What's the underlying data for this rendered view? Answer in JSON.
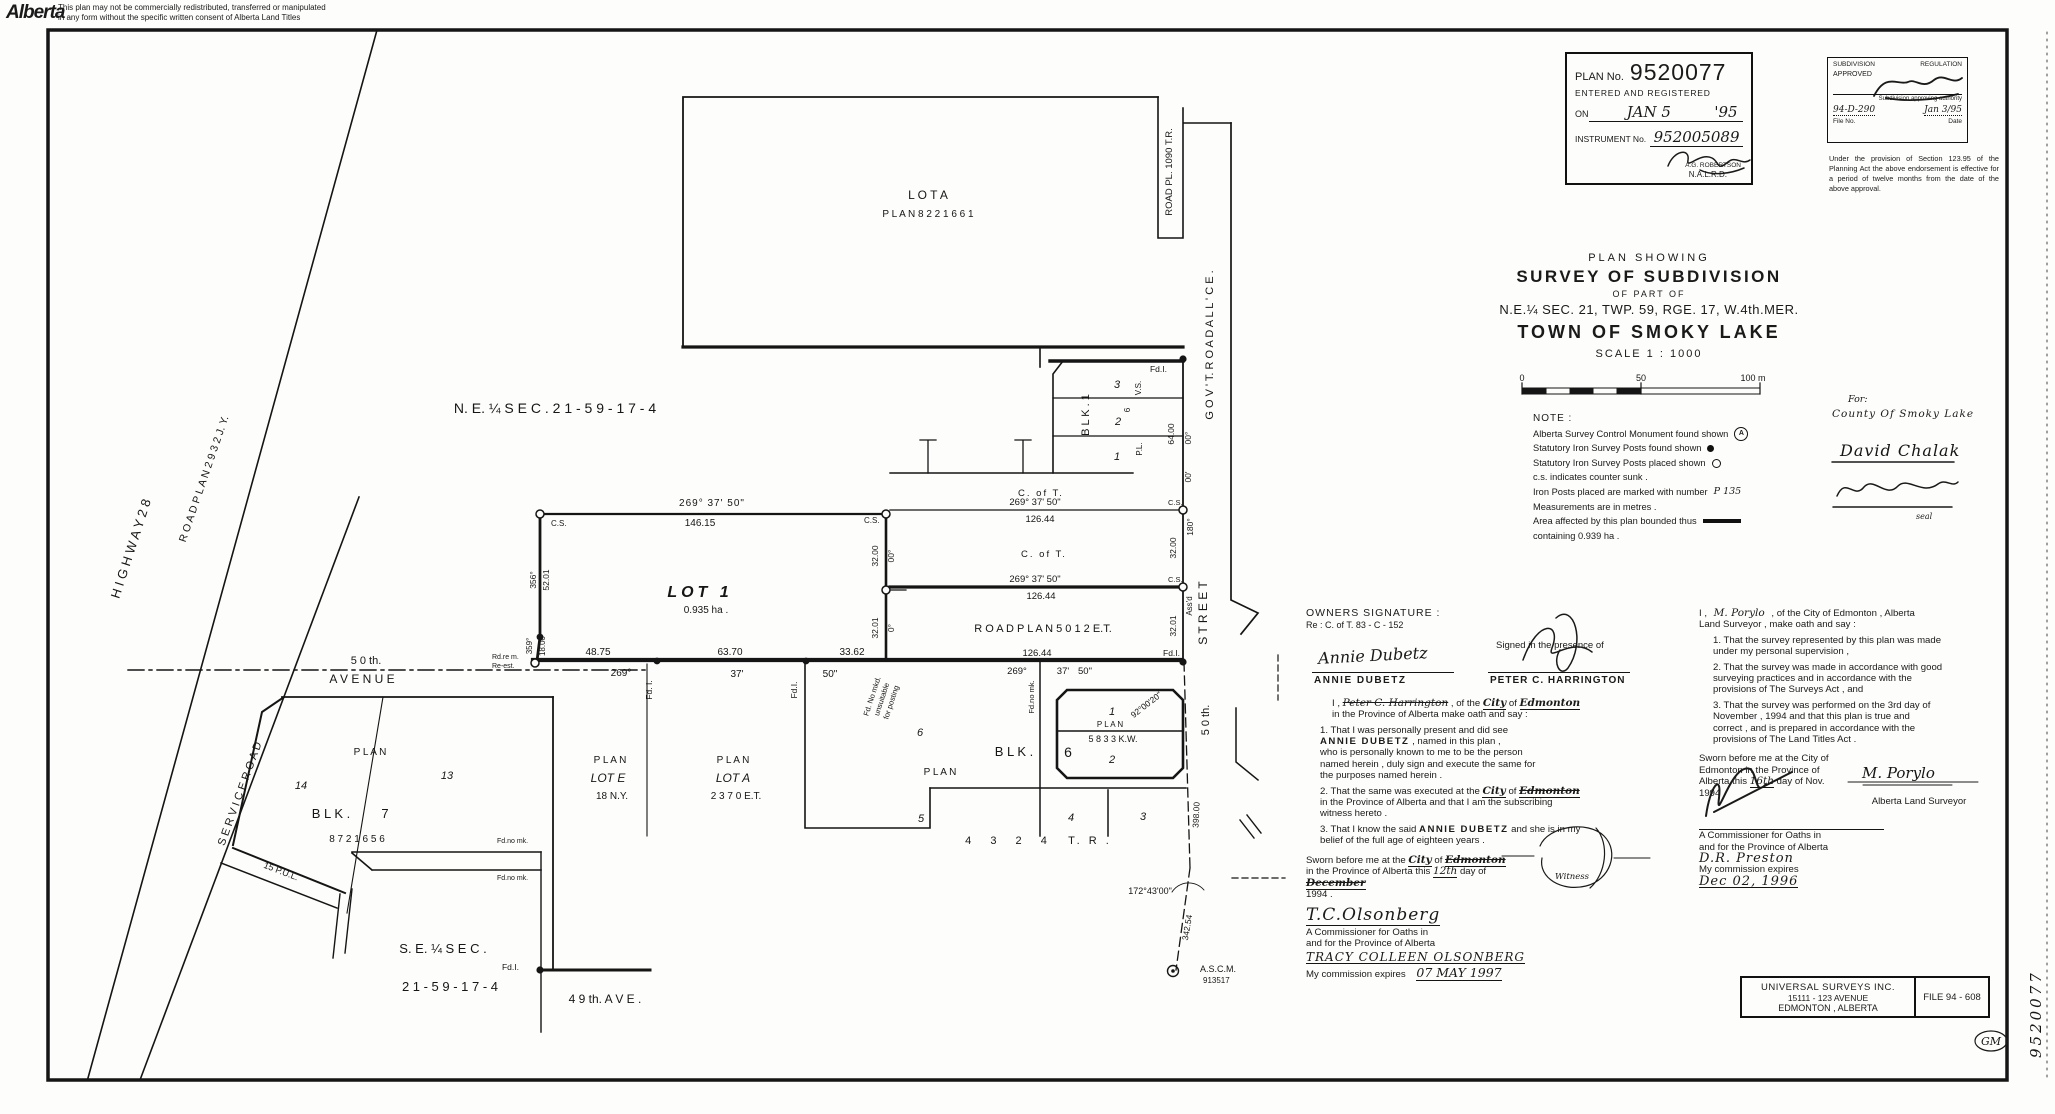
{
  "page": {
    "logo": "Alberta",
    "disclaimer1": "This plan may not be commercially redistributed, transferred or manipulated",
    "disclaimer2": "in any form without the specific written consent of Alberta Land Titles",
    "margin_plan_no": "9520077",
    "margin_initials": "GM"
  },
  "stamps": {
    "registration": {
      "plan_no_label": "PLAN No.",
      "plan_no": "9520077",
      "entered": "ENTERED AND REGISTERED",
      "on_label": "ON",
      "on_date": "JAN  5",
      "on_year": "'95",
      "instrument_label": "INSTRUMENT No.",
      "instrument_no": "952005089",
      "registrar": "A.G. ROBERTSON",
      "office": "N.A.L.R.D."
    },
    "approval": {
      "title_left": "SUBDIVISION",
      "title_right": "REGULATION",
      "approved": "APPROVED",
      "authority": "Subdivision approving authority",
      "file_value": "94-D-290",
      "date_value": "Jan 3/95",
      "file_label": "File No.",
      "date_label": "Date",
      "caveat": "Under the provision of Section 123.95 of the Planning Act the above endorsement is effective for a period of twelve months from the date of the above approval."
    }
  },
  "title_block": {
    "line1": "PLAN  SHOWING",
    "line2": "SURVEY  OF  SUBDIVISION",
    "line3": "OF  PART  OF",
    "line4": "N.E.¼ SEC. 21, TWP. 59, RGE. 17, W.4th.MER.",
    "line5": "TOWN  OF  SMOKY  LAKE",
    "scale": "SCALE   1 : 1000",
    "scale_0": "0",
    "scale_50": "50",
    "scale_100": "100 m",
    "for_label": "For:",
    "for_name": "County Of Smoky Lake",
    "signature1": "David Chalak",
    "seal": "seal"
  },
  "note": {
    "title": "NOTE :",
    "l1": "Alberta Survey Control Monument found shown",
    "l2": "Statutory Iron Survey Posts found shown",
    "l3": "Statutory Iron Survey Posts placed shown",
    "l4": "c.s. indicates counter sunk .",
    "l5": "Iron Posts placed are marked with number",
    "l5v": "P 135",
    "l6": "Measurements are in metres .",
    "l7": "Area affected by this plan bounded thus",
    "l8": "containing   0.939 ha ."
  },
  "owners": {
    "heading": "OWNERS  SIGNATURE :",
    "ref": "Re :  C. of T.  83 - C - 152",
    "owner_sig": "Annie Dubetz",
    "owner_name": "ANNIE  DUBETZ",
    "presence": "Signed in the presence of",
    "witness_name": "PETER  C. HARRINGTON",
    "intro_pre": "I ,",
    "intro_name": "Peter C. Harrington",
    "intro_mid": " , of the ",
    "intro_city": "City",
    "intro_of": " of ",
    "intro_place": "Edmonton",
    "intro_l2": "in the Province of Alberta make oath and say :",
    "item1a": "1. That I was personally present and did see\n",
    "item1_name": "ANNIE  DUBETZ",
    "item1b": " , named in this plan ,\nwho is personally known to me to be the person\nnamed herein , duly sign and execute the same for\nthe purposes named herein .",
    "item2a": "2. That the same was executed at the ",
    "item2_city": "City",
    "item2_of": " of ",
    "item2_place": "Edmonton",
    "item2b": "\nin the Province of Alberta and that I am the subscribing\nwitness hereto .",
    "item3a": "3. That I know the said ",
    "item3_name": "ANNIE  DUBETZ",
    "item3b": " and she is in my\nbelief of the full age of eighteen years .",
    "sworn_a": "Sworn before me at the ",
    "sworn_city": "City",
    "sworn_of": " of",
    "sworn_place": "Edmonton",
    "sworn_b": " in the Province of",
    "sworn_c": "Alberta this ",
    "sworn_day": "12th",
    "sworn_d": " day of ",
    "sworn_month": "December",
    "sworn_year": "1994 .",
    "witness_circle": "Witness",
    "comm_sig": "T.C.Olsonberg",
    "comm_l1": "A Commissioner for Oaths in",
    "comm_l2": "and for the Province of Alberta",
    "comm_name": "TRACY  COLLEEN  OLSONBERG",
    "comm_exp": "My commission expires",
    "comm_date": "07 MAY 1997"
  },
  "surveyor": {
    "intro_pre": "I ,",
    "intro_name": "M. Porylo",
    "intro_post": " , of the City of Edmonton ,  Alberta",
    "intro_l2": "Land Surveyor , make oath and say :",
    "item1": "1. That the survey represented by this plan was made\nunder my personal supervision ,",
    "item2": "2. That the survey was made in accordance with good\nsurveying practices and in accordance with the\nprovisions of The Surveys Act , and",
    "item3": "3. That the survey was performed on the 3rd day of\nNovember , 1994 and that this plan is true and\ncorrect , and is prepared in accordance with the\nprovisions of The Land Titles Act .",
    "sworn_l1": "Sworn before me at the City of",
    "sworn_l2": "Edmonton in the Province of",
    "sworn_l3a": "Alberta this ",
    "sworn_day": "16th",
    "sworn_l3b": " day of Nov.",
    "sworn_l4": "1994",
    "comm_l1": "A Commissioner for Oaths in",
    "comm_l2": "and for the Province of Alberta",
    "comm_name": "D.R. Preston",
    "comm_exp": "My commission expires",
    "comm_date": "Dec 02, 1996",
    "als_sig": "M. Porylo",
    "als_label": "Alberta Land Surveyor"
  },
  "footer": {
    "company1": "UNIVERSAL  SURVEYS  INC.",
    "company2": "15111 - 123 AVENUE",
    "company3": "EDMONTON , ALBERTA",
    "file": "FILE  94 - 608"
  },
  "map": {
    "ne_label": "N. E. ¼  S E C .   2 1 - 5 9 - 1 7 - 4",
    "se_label1": "S. E. ¼  S E C .",
    "se_label2": "2 1 - 5 9 - 1 7 - 4",
    "ave49": "4 9 th. A V E .",
    "ave50_1": "5 0 th.",
    "ave50_2": "A V E N U E",
    "hw28": "H I G H W A Y    2 8",
    "service": "S E R V I C E    R O A D",
    "rp2932": "R O A D   P L A N   2 9 3 2  J. Y.",
    "rp1090": "ROAD  PL. 1090 T.R.",
    "govt": "G O V ' T.    R O A D    A L L ' C E .",
    "st50": "5 0 th.",
    "street": "S T R E E T",
    "lota_top1": "L O T    A",
    "lota_top2": "P L A N     8 2 2 1 6 6 1",
    "lot1": "LOT  1",
    "lot1_area": "0.935 ha .",
    "b269": "269°  37'  50\"",
    "d146": "146.15",
    "d4875": "48.75",
    "d6370": "63.70",
    "d3362": "33.62",
    "b269p": "269°",
    "b37": "37'",
    "b50": "50\"",
    "d3200": "32.00",
    "b00": "00°",
    "b00m": "00'",
    "d3201": "32.01",
    "b0": "0°",
    "b180": "180°",
    "assd": "Ass'd",
    "d5201": "52.01",
    "b356": "356°",
    "d1800": "18.00",
    "b359": "359°",
    "d6400": "64.00",
    "cs": "C.S.",
    "coft": "C. of T.",
    "d12644": "126.44",
    "rp5012": "R O A D   P L A N    5 0 1 2  E.T.",
    "fdi": "Fd.I.",
    "fdi2": "Fd. I.",
    "fdnomk": "Fd.no mk.",
    "fdnomkd1": "Fd. No mkd.",
    "fdnomkd2": "unsuitable",
    "fdnomkd3": "for posting",
    "rdrem1": "Rd.re m.",
    "rdrem2": "Re-est.",
    "blk1": "B L K .   1",
    "n3": "3",
    "n2": "2",
    "n1": "1",
    "vs": "V.S.",
    "n6": "6",
    "pl": "P.L.",
    "blk": "B L K .",
    "n5": "5",
    "n4": "4",
    "n14": "14",
    "n13": "13",
    "n7": "7",
    "p8721656": "8 7 2   1 6 5 6",
    "pul": "15 P.U.L.",
    "plan_spread": "P  L  A  N",
    "p5833": "5 8 3 3  K.W.",
    "b92": "92°00'20\"",
    "p4324a": "4  3  2  4",
    "p4324b": "T.  R .",
    "lote1": "P L A N",
    "lote2": "LOT   E",
    "lote3": "18 N.Y.",
    "lotam1": "P L A N",
    "lotam2": "LOT   A",
    "lotam3": "2 3 7 0  E.T.",
    "d398": "398.00",
    "b172": "172°43'00\"",
    "d342": "342.54",
    "ascm1": "A.S.C.M.",
    "ascm2": "913517"
  }
}
